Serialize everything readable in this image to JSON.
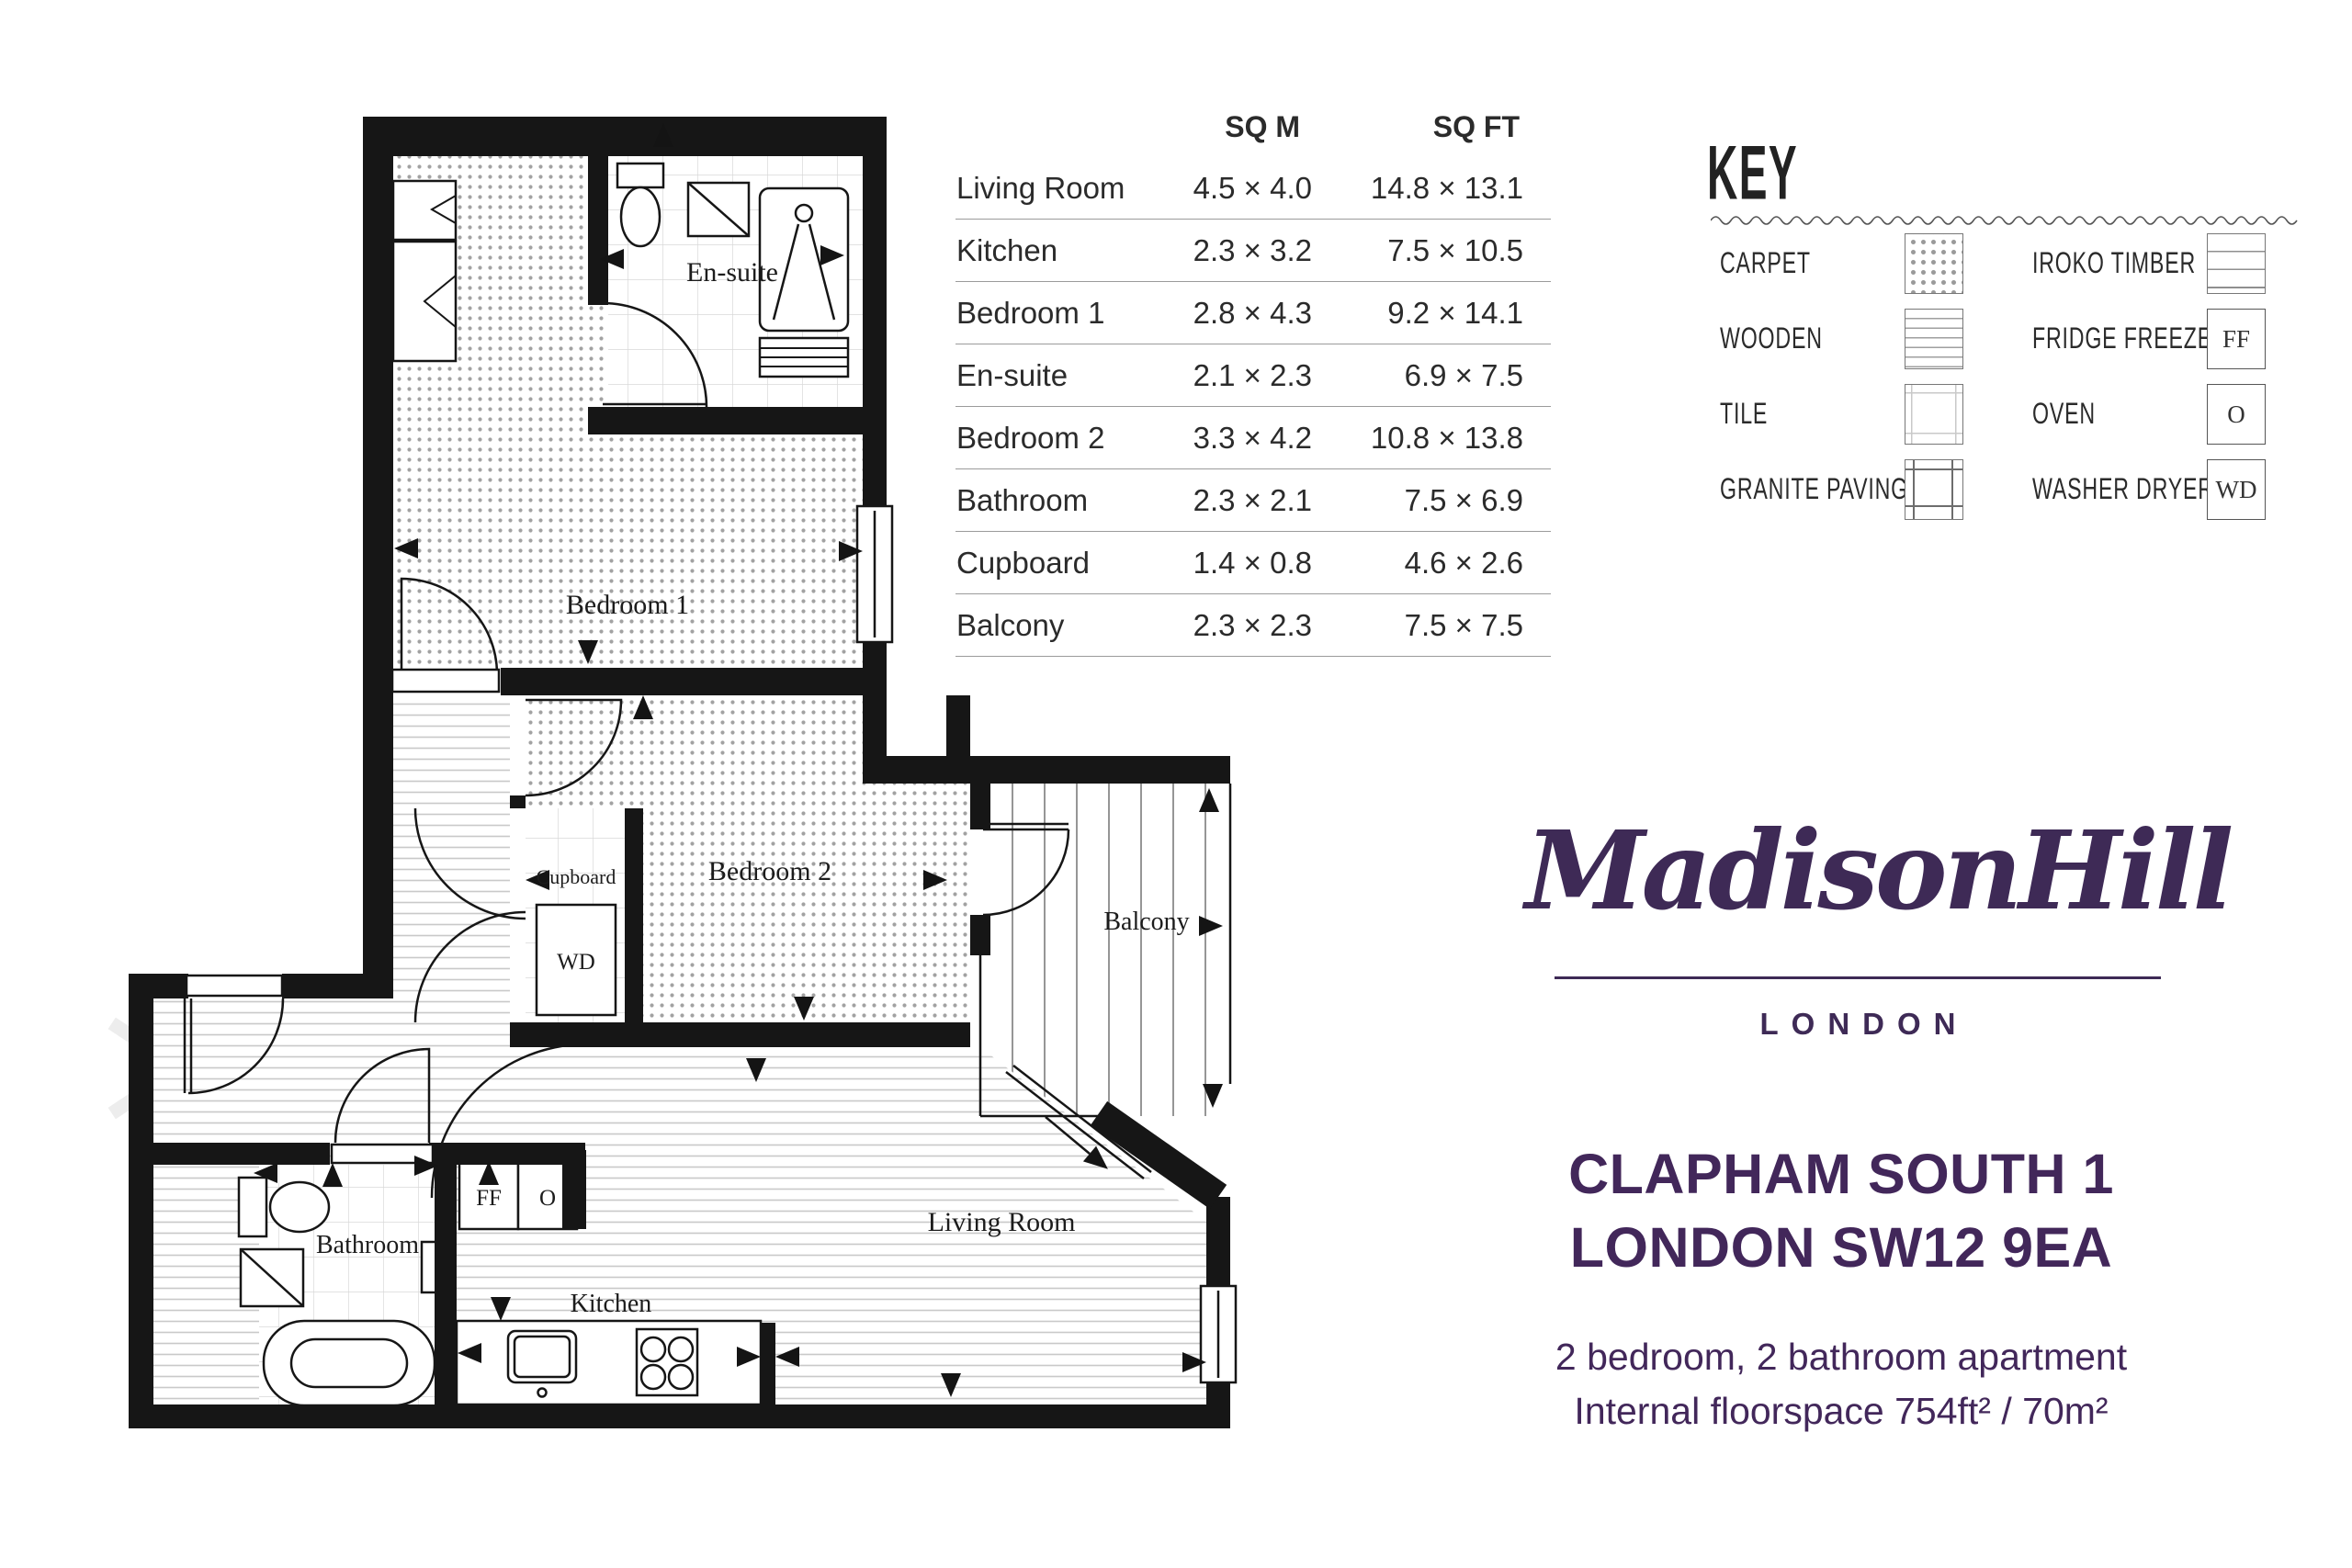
{
  "colors": {
    "brand_purple": "#42275A",
    "logo_purple": "#3E2A56",
    "ink": "#231F20"
  },
  "floor_plan": {
    "room_labels": {
      "bedroom1": "Bedroom 1",
      "ensuite": "En-suite",
      "bedroom2": "Bedroom 2",
      "cupboard": "Cupboard",
      "balcony": "Balcony",
      "bathroom": "Bathroom",
      "kitchen": "Kitchen",
      "living_room": "Living Room"
    },
    "appliance_labels": {
      "washer_dryer": "WD",
      "fridge_freezer": "FF",
      "oven": "O"
    }
  },
  "dimensions_table": {
    "col_sqm": "SQ M",
    "col_sqft": "SQ FT",
    "rows": [
      {
        "room": "Living Room",
        "sq_m": "4.5 × 4.0",
        "sq_ft": "14.8 × 13.1"
      },
      {
        "room": "Kitchen",
        "sq_m": "2.3 × 3.2",
        "sq_ft": "7.5 × 10.5"
      },
      {
        "room": "Bedroom 1",
        "sq_m": "2.8 × 4.3",
        "sq_ft": "9.2 × 14.1"
      },
      {
        "room": "En-suite",
        "sq_m": "2.1 × 2.3",
        "sq_ft": "6.9 × 7.5"
      },
      {
        "room": "Bedroom 2",
        "sq_m": "3.3 × 4.2",
        "sq_ft": "10.8 × 13.8"
      },
      {
        "room": "Bathroom",
        "sq_m": "2.3 × 2.1",
        "sq_ft": "7.5 × 6.9"
      },
      {
        "room": "Cupboard",
        "sq_m": "1.4 × 0.8",
        "sq_ft": "4.6 × 2.6"
      },
      {
        "room": "Balcony",
        "sq_m": "2.3 × 2.3",
        "sq_ft": "7.5 × 7.5"
      }
    ]
  },
  "key": {
    "title": "KEY",
    "left_items": [
      {
        "label": "CARPET"
      },
      {
        "label": "WOODEN"
      },
      {
        "label": "TILE"
      },
      {
        "label": "GRANITE PAVING"
      }
    ],
    "right_items": [
      {
        "label": "IROKO TIMBER",
        "code": ""
      },
      {
        "label": "FRIDGE FREEZER",
        "code": "FF"
      },
      {
        "label": "OVEN",
        "code": "O"
      },
      {
        "label": "WASHER DRYER",
        "code": "WD"
      }
    ]
  },
  "brand": {
    "logo": "MadisonHill",
    "city": "LONDON"
  },
  "property": {
    "title_line1": "CLAPHAM SOUTH 1",
    "title_line2": "LONDON SW12 9EA",
    "summary_line1": "2 bedroom, 2 bathroom apartment",
    "summary_line2": "Internal floorspace 754ft² / 70m²"
  }
}
